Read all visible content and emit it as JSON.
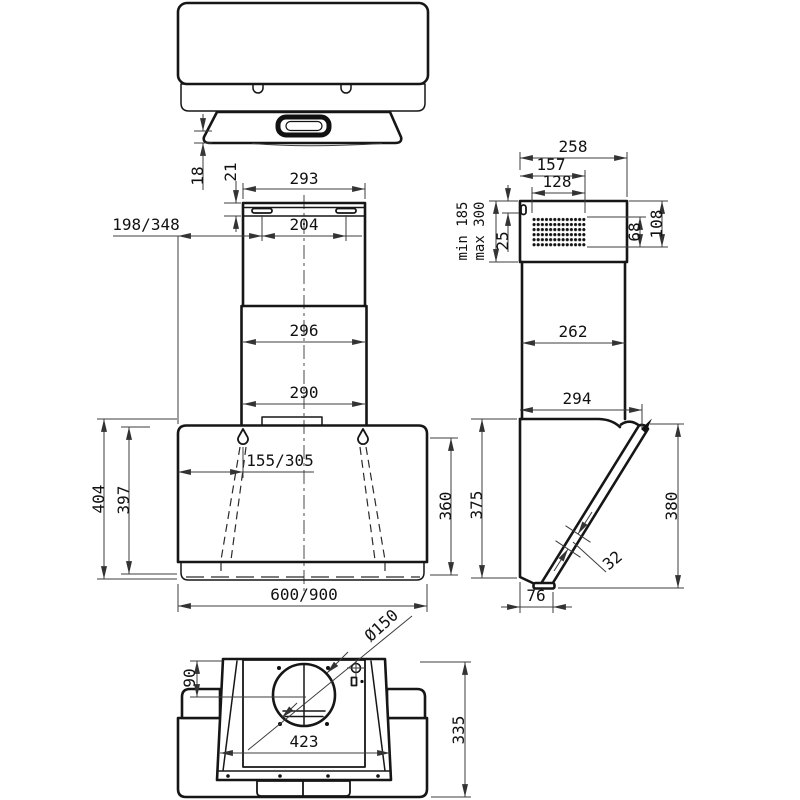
{
  "drawing": {
    "title": "Wall-mounted cooker hood — installation dimension drawing",
    "units": "mm",
    "views": {
      "top": {
        "dims": {
          "glass_overhang": "18"
        }
      },
      "front": {
        "dims": {
          "slot_top_offset": "21",
          "chimney_width_top": "293",
          "bracket_slot_spacing": "204",
          "bracket_side_offset": "198/348",
          "chimney_width_mid": "296",
          "chimney_width_base": "290",
          "keyhole_offset": "155/305",
          "body_height_total": "404",
          "body_height_front": "397",
          "glass_height_right": "360",
          "body_width": "600/900"
        }
      },
      "side": {
        "dims": {
          "top_width": "258",
          "vent_offset_width": "157",
          "vent_width": "128",
          "chimney_min": "min 185",
          "chimney_max": "max 300",
          "slot_offset": "25",
          "vent_height": "68",
          "vent_total_height": "108",
          "chimney_depth": "262",
          "body_depth_top": "294",
          "body_height_back": "375",
          "glass_height": "380",
          "glass_thickness": "32",
          "body_depth_bottom": "76"
        }
      },
      "bottom": {
        "dims": {
          "duct_center_offset": "90",
          "duct_diameter": "Ø150",
          "inner_width": "423",
          "body_depth": "335"
        }
      }
    }
  }
}
